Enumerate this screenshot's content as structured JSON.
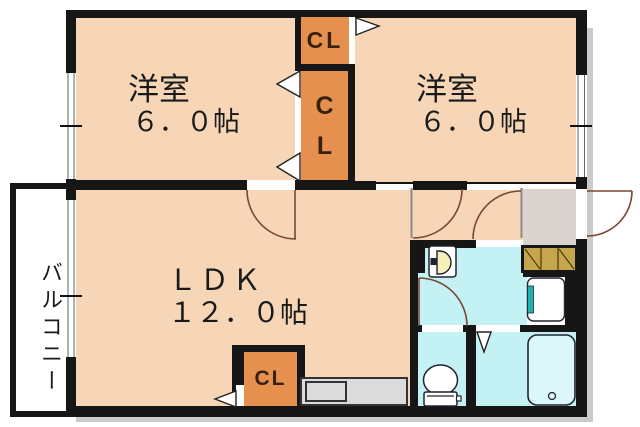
{
  "plan": {
    "title": "apartment-floor-plan",
    "rooms": {
      "bedroom_left": {
        "label": "洋室",
        "size": "６．０帖"
      },
      "bedroom_right": {
        "label": "洋室",
        "size": "６．０帖"
      },
      "ldk": {
        "label": "ＬＤＫ",
        "size": "１２．０帖"
      },
      "balcony": {
        "label": "バルコニー"
      },
      "closet_top": {
        "label": "CL"
      },
      "closet_mid": {
        "label": "CL"
      },
      "closet_ldk": {
        "label": "CL"
      }
    },
    "fixtures": [
      "toilet-icon",
      "bathtub-icon",
      "washbasin-icon",
      "washing-machine-pan-icon",
      "shoe-cabinet-icon",
      "door-swing-arc",
      "folding-door-marker",
      "window-marker"
    ],
    "colors": {
      "room": "#F6D6B6",
      "closet": "#E5904F",
      "wet": "#C4F2F4",
      "tub": "#DCF7F9",
      "wall": "#161616",
      "counter": "#DBDBDB",
      "genkan": "#D9D4CF",
      "shoe": "#C6A64C",
      "arc": "#7B4634",
      "teal": "#1FB1AD",
      "shadow": "#CBCBCB",
      "ink": "#1A1A1A",
      "clink": "#38200A"
    }
  }
}
